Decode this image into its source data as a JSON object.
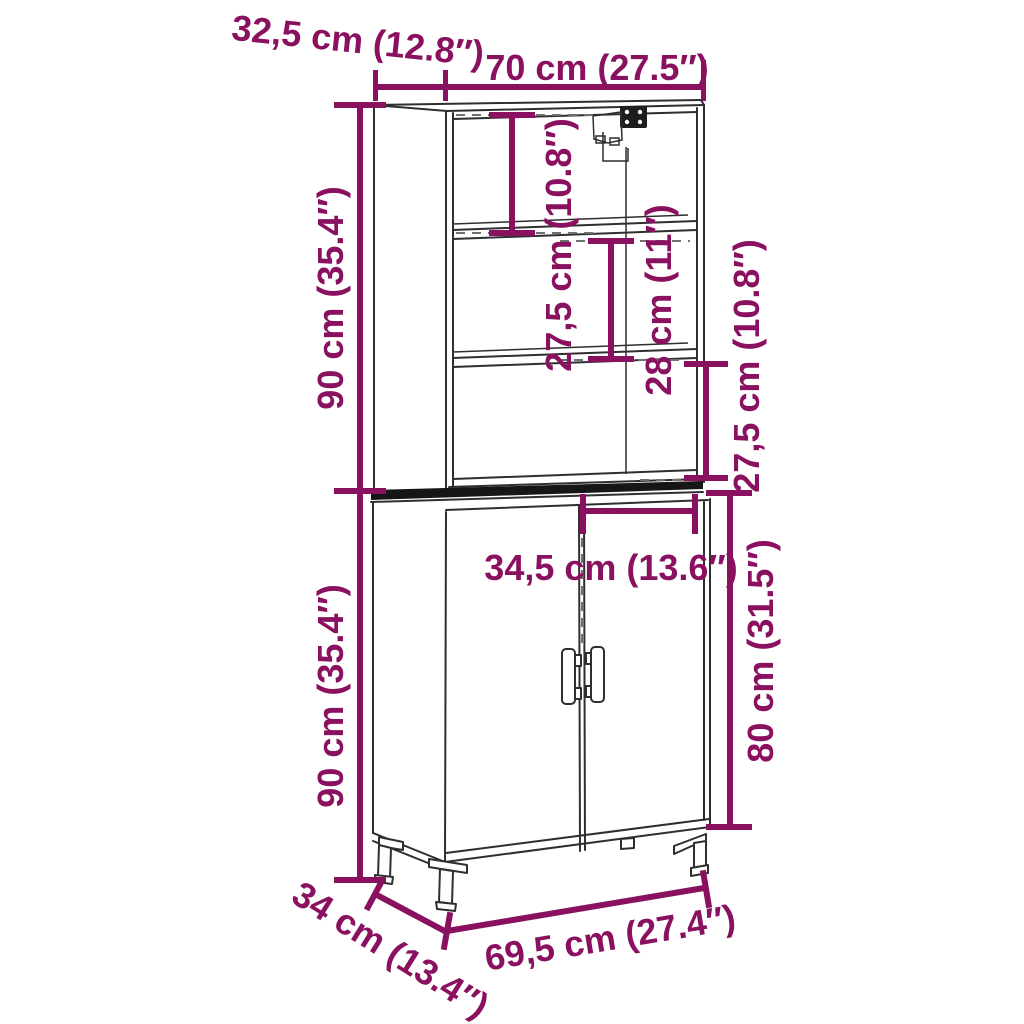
{
  "diagram": {
    "kind": "furniture-dimension-diagram",
    "item": "highboard cabinet with open top shelves, two doors and metal legs",
    "background": "#ffffff"
  },
  "colors": {
    "dimension_accent": "#8a115f",
    "outline": "#2f2f2f",
    "shadow_band": "#161616",
    "extension_dash": "#707070"
  },
  "icons": {
    "wall_mount_bracket": "wall-mount-bracket-icon"
  },
  "dimensions": {
    "top_depth": {
      "label": "32,5 cm (12.8″)"
    },
    "top_width": {
      "label": "70 cm (27.5″)"
    },
    "upper_height": {
      "label": "90 cm (35.4″)"
    },
    "shelf_gap_1": {
      "label": "27,5 cm (10.8″)"
    },
    "shelf_gap_2": {
      "label": "28 cm (11″)"
    },
    "shelf_gap_3": {
      "label": "27,5 cm (10.8″)"
    },
    "door_width": {
      "label": "34,5 cm (13.6″)"
    },
    "door_height": {
      "label": "80 cm (31.5″)"
    },
    "lower_height": {
      "label": "90 cm (35.4″)"
    },
    "base_depth": {
      "label": "34 cm (13.4″)"
    },
    "base_width": {
      "label": "69,5 cm (27.4″)"
    }
  }
}
